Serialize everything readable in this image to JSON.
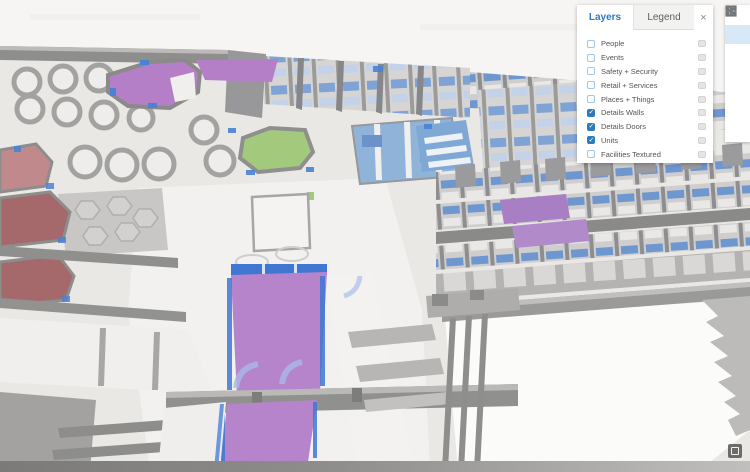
{
  "panel": {
    "tabs": [
      {
        "label": "Layers",
        "active": true
      },
      {
        "label": "Legend",
        "active": false
      }
    ],
    "close_glyph": "×",
    "layers": [
      {
        "label": "People",
        "checked": false
      },
      {
        "label": "Events",
        "checked": false
      },
      {
        "label": "Safety + Security",
        "checked": false
      },
      {
        "label": "Retail + Services",
        "checked": false
      },
      {
        "label": "Places + Things",
        "checked": false
      },
      {
        "label": "Details Walls",
        "checked": true
      },
      {
        "label": "Details Doors",
        "checked": true
      },
      {
        "label": "Units",
        "checked": true
      },
      {
        "label": "Facilities Textured",
        "checked": false
      }
    ]
  },
  "toolbar": {
    "active_index": 1,
    "icons": [
      "search-icon",
      "globe-icon",
      "basemap-icon",
      "gear-icon",
      "legend-list-icon",
      "share-icon",
      "wrench-icon"
    ]
  },
  "colors": {
    "accent_blue": "#2a7cc0",
    "checkbox_border_blue": "#a5c6e4",
    "unit_purple": "#b37fc8",
    "unit_green": "#a3ca7c",
    "unit_blue": "#7fa8d4",
    "unit_red_dark": "#a5686b",
    "unit_red_light": "#c08a8c",
    "door_blue": "#4a82d6",
    "wall_gray": "#8f8f8d",
    "floor_light": "#e9e8e5"
  }
}
